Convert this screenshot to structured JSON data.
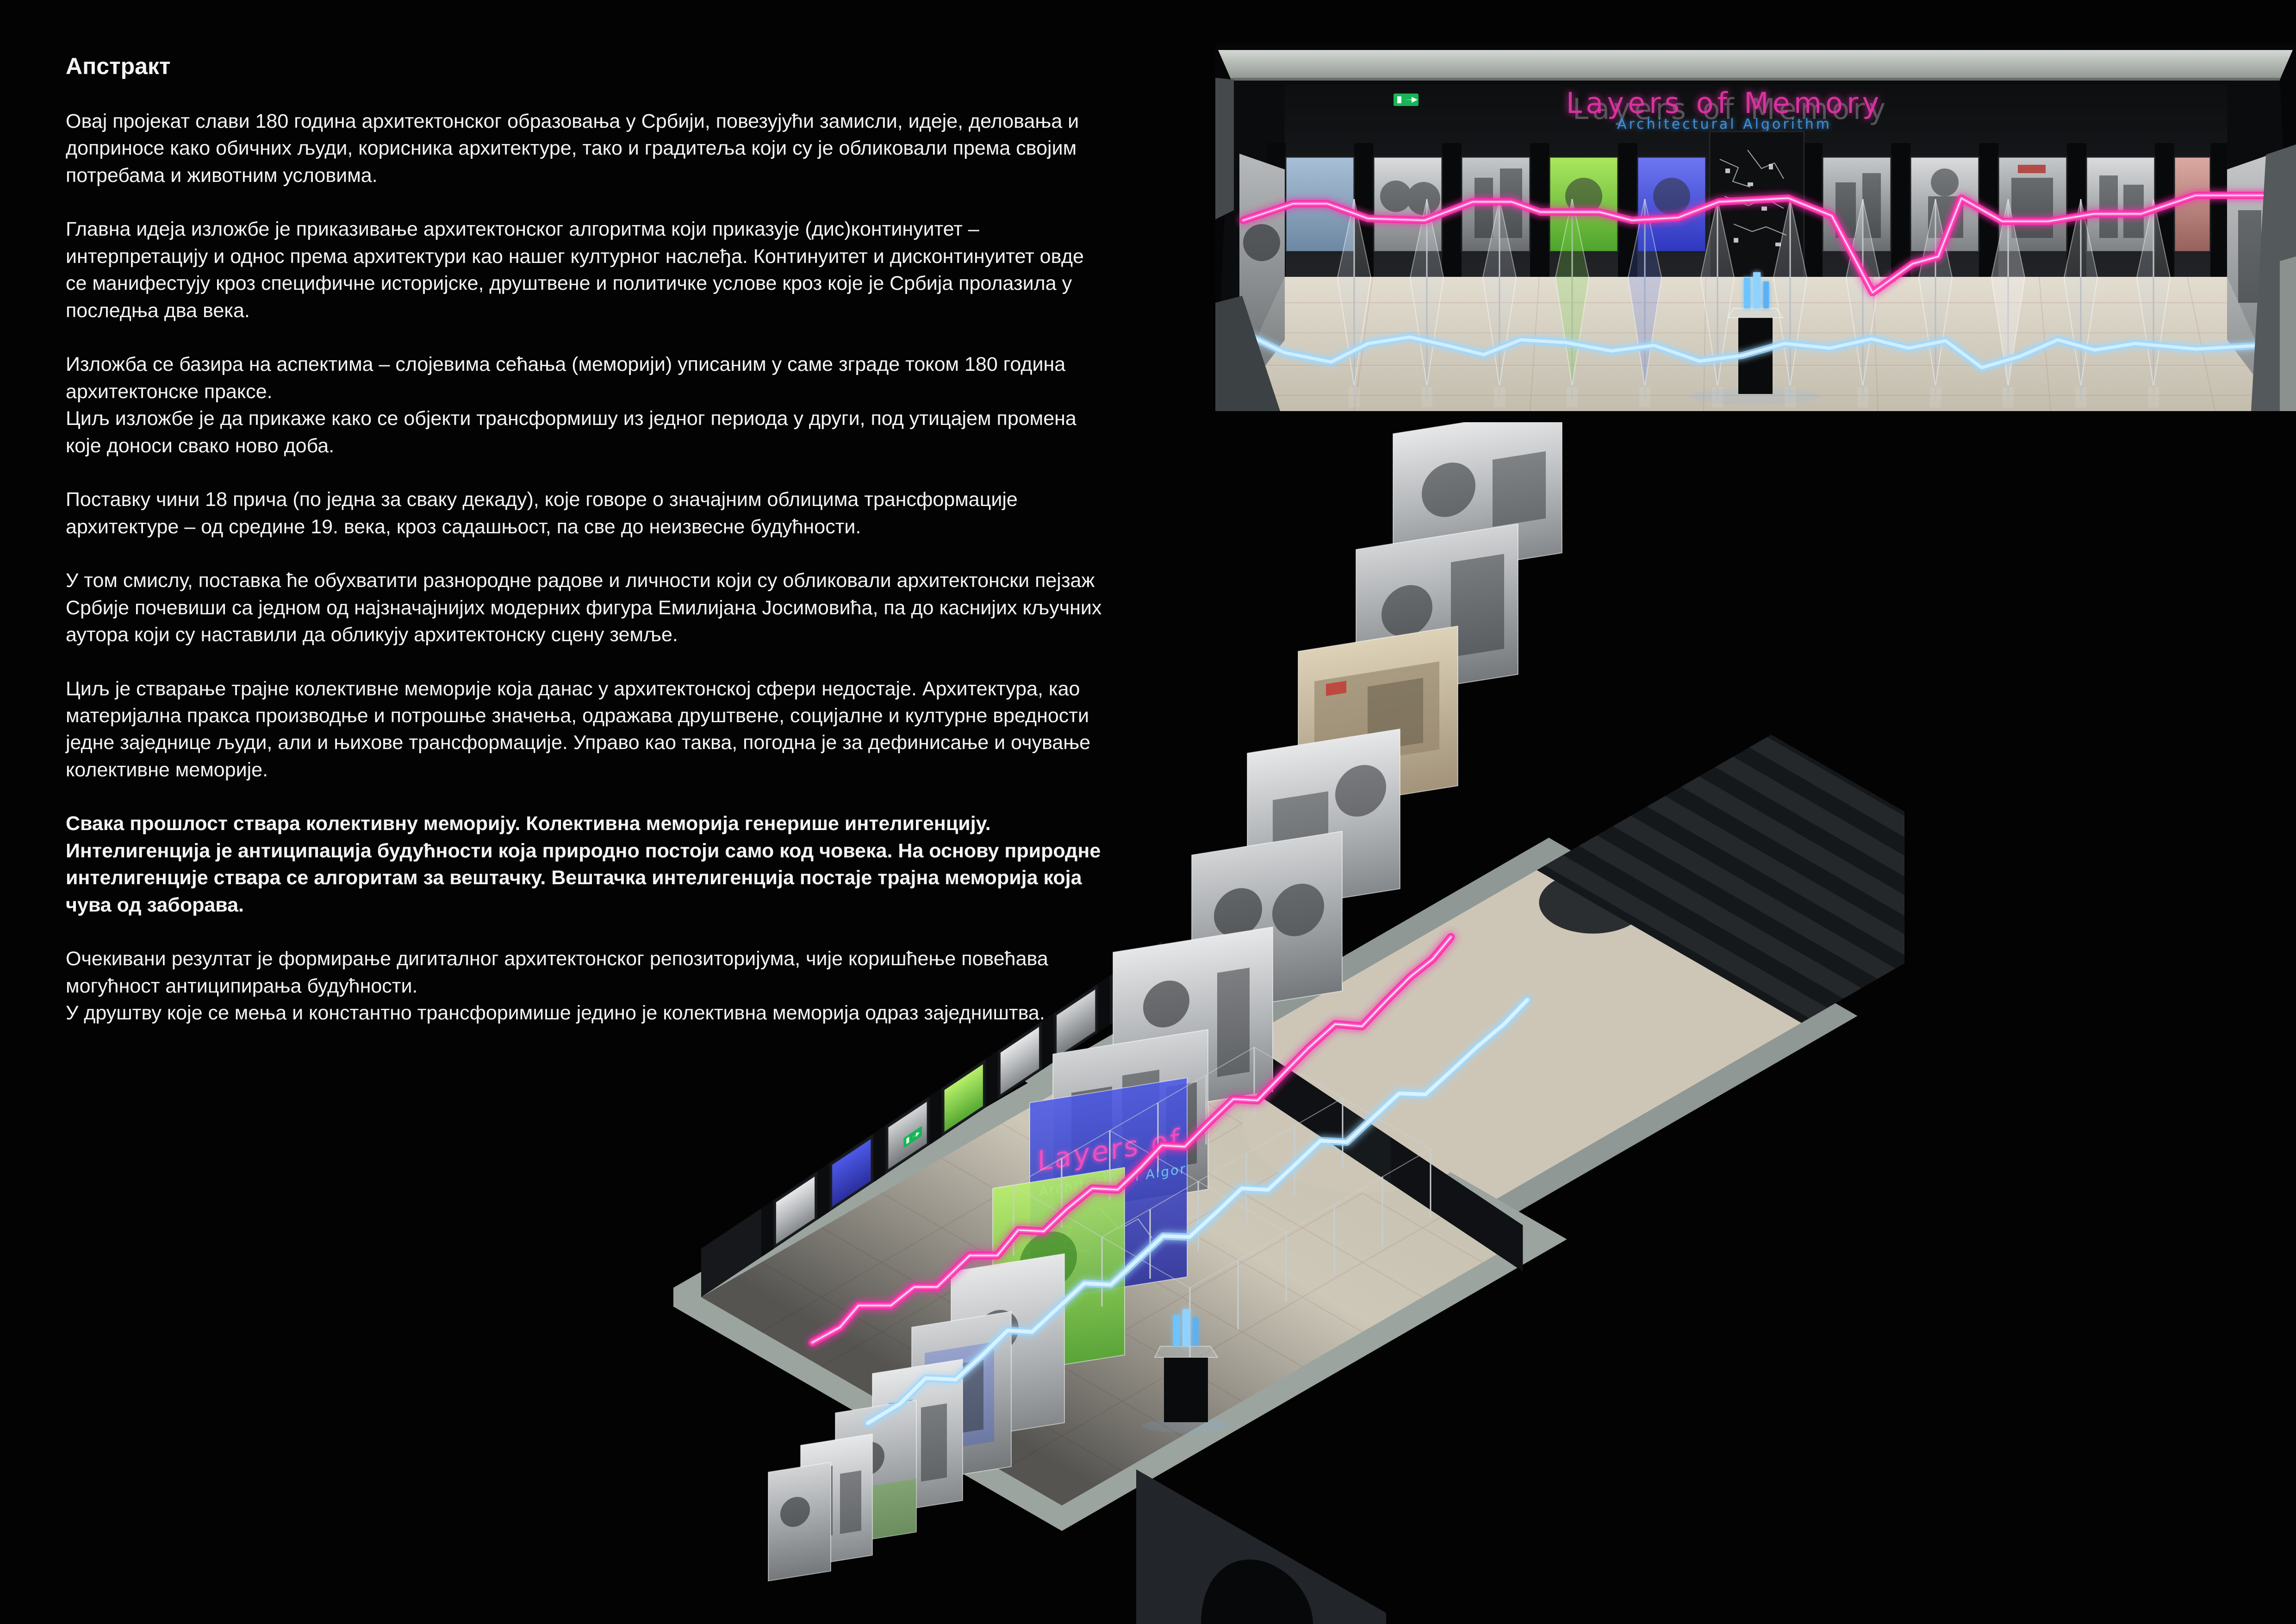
{
  "page": {
    "background": "#030304",
    "description_language": "Serbian (Cyrillic)"
  },
  "abstract": {
    "title": "Апстракт",
    "paragraphs": [
      {
        "text": "Овај пројекат слави 180 година архитектонског образовања у Србији, повезујући замисли, идеје, деловања и доприносе како обичних људи, корисника архитектуре, тако и градитеља који су је обликовали према својим потребама и животним условима.",
        "bold": false
      },
      {
        "text": "Главна идеја изложбе је приказивање архитектонског алгоритма који приказује (дис)континуитет – интерпретацију и однос према архитектури као нашег културног наслеђа. Континуитет и дисконтинуитет овде се манифестују кроз специфичне историјске, друштвене и политичке услове кроз које је Србија пролазила у последња два века.",
        "bold": false
      },
      {
        "text": "Изложба се базира на аспектима – слојевима сећања (меморији) уписаним у саме зграде током 180 година архитектонске праксе.\nЦиљ изложбе је да прикаже како се објекти трансформишу из једног периода у други, под утицајем промена које доноси свако ново доба.",
        "bold": false
      },
      {
        "text": "Поставку чини 18 прича (по једна за сваку декаду), које говоре о значајним облицима трансформације архитектуре – од средине 19. века, кроз садашњост, па све до неизвесне будућности.",
        "bold": false
      },
      {
        "text": "У том смислу, поставка ће обухватити разнородне радове и личности који су обликовали архитектонски пејзаж Србије почевиши са једном од најзначајнијих модерних фигура Емилијана Јосимовића, па до каснијих кључних аутора који су наставили да обликују архитектонску сцену земље.",
        "bold": false
      },
      {
        "text": "Циљ је стварање трајне колективне меморије која данас у архитектонској сфери недостаје. Архитектура, као материјална пракса производње и потрошње значења, одражава друштвене, социјалне и културне вредности једне заједнице људи, али и њихове трансформације. Управо као таква, погодна је за дефинисање и очување колективне меморије.",
        "bold": false
      },
      {
        "text": "Свака прошлост ствара колективну меморију. Колективна меморија генерише интелигенцију. Интелигенција је антиципација будућности која природно постоји само код човека. На основу природне интелигенције ствара се алгоритам за вештачку. Вештачка интелигенција постаје трајна меморија која чува од заборава.",
        "bold": true
      },
      {
        "text": "Очекивани резултат је формирање дигиталног архитектонског репозиторијума, чије коришћење повећава могућност антиципирања будућности.\nУ друштву које се мења и константно трансфоримише једино је колективна меморија одраз заједништва.",
        "bold": false
      }
    ]
  },
  "exhibit": {
    "sign": {
      "title": "Layers of Memory",
      "subtitle": "Architectural Algorithm"
    },
    "colors": {
      "neon_pink": "#ff35b2",
      "neon_cyan": "#bfe9ff",
      "sign_magenta": "#d8309f",
      "sign_blue": "#3f8fd4",
      "floor_beige": "#d8d2c3",
      "wall_grey": "#9ba49f",
      "exit_green": "#18b457"
    }
  }
}
